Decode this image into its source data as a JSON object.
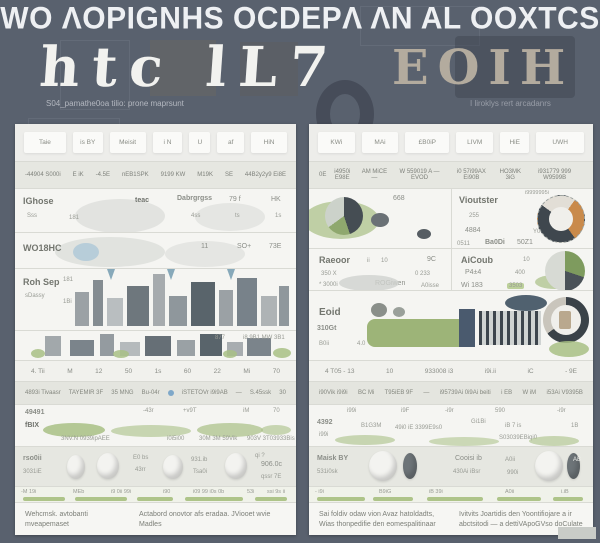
{
  "colors": {
    "background": "#59616e",
    "panel": "#f5f5f2",
    "row_gray": "#e6e7e1",
    "accent_green": "#a8bf85",
    "accent_orange": "#c98a4b",
    "accent_dark": "#3f474e",
    "wordmark_beige": "#b3ab9e",
    "title_white": "#eef0f3"
  },
  "header": {
    "title": "WO ΛOPIGNHS OCDEPΛ ΛN AL OOXTCS",
    "wordmark_left": "htc lL7",
    "wordmark_right": "EOIH",
    "caption_left": "S04_pamathe0oa tilio: prone maprsunt",
    "caption_right": "I liroklys rert arcadanrs"
  },
  "left": {
    "header_cells": [
      "Taie",
      "is  BY",
      "Meisit",
      "i N",
      "U",
      "af",
      "HiN"
    ],
    "subheader_cells": [
      "-44904 S000i",
      "E iK",
      "-4.5E",
      "nEB1SPK",
      "9199 KW",
      "M19K",
      "SE",
      "44B2y2y9 Ei8E"
    ],
    "row_a": {
      "name": "IGhose",
      "sub": "Sss",
      "n1": "181",
      "v1": "teac",
      "v2": "Dabrgrgss",
      "v2s": "4ss",
      "v3": "79 f",
      "v3s": "ts",
      "v4": "HK",
      "v4s": "1s"
    },
    "row_b": {
      "name": "WO18HC",
      "v1": "11",
      "v2": "SO+",
      "v3": "73E"
    },
    "row_c": {
      "name": "Roh Sep",
      "sub": "sDassy",
      "n1": "181",
      "n2": "1Bi"
    },
    "row_d": {
      "v1": "877",
      "v2": "i8 9B1 MW 3B1"
    },
    "numbers_row": [
      "4. Tii",
      "M",
      "12",
      "50",
      "1s",
      "60",
      "22",
      "Mi",
      "70"
    ],
    "gray_row": [
      "4893i Tivaasr",
      "TAYEMIR 3F",
      "35 MNG",
      "Bu-04r",
      "iSTETOVr i9i9AB",
      "—",
      "S.45ssk",
      "30"
    ],
    "hills_row": {
      "name": "49491",
      "sub": "fBIX",
      "v1": "-43r",
      "v2": "+v9T",
      "v3": "iM",
      "v4": "70",
      "cap1": "3NV.N 0939ipAEE",
      "cap2": "i0i5i00",
      "cap3": "30M 3M 59Vik",
      "cap4": "903V 3T03933Bis"
    },
    "stones_row": {
      "name": "rso0ii",
      "sub": "3031iE",
      "v1": "E0 bs",
      "v1s": "43rr",
      "v2": "931.ib",
      "v2s": "Tsa0i",
      "v3": "qi ?",
      "v4": "906.0c",
      "v4s": "qssr 7E"
    },
    "bars_row": {
      "l1": "-M 19i",
      "l2": "MEb",
      "l3": "i9 0ii 99i",
      "l4": "i90",
      "l5": "i09 99 i0s 0b",
      "l6": "53i",
      "l7": "ssi 9s ii"
    },
    "footnote_a": "Wehcmsk. avtobanti mveapemaset",
    "footnote_b": "Actabord onovtor afs eradaa. JViooet wvie Madles"
  },
  "right": {
    "header_cells": [
      "KWi",
      "MAi",
      "£B0iP",
      "LIVM",
      "HiE",
      "UWH"
    ],
    "subheader_cells": [
      "0E",
      "i4950i E98E",
      "AM  MiCE —",
      "W 559019 A — EVOD",
      "i0 57i99AX Ei90B",
      "HO3MK 3iG",
      "i931779 999 W9599B"
    ],
    "note": "i9999995i",
    "row_a": {
      "n0": "668",
      "name": "Vioutster",
      "sub1": "255",
      "sub2": "4884",
      "r1": "0511",
      "r2": "Ba0Di",
      "r3": "50Z1",
      "r4": "Y0"
    },
    "row_b": {
      "name": "Raeoor",
      "n1": "ii",
      "n2": "10",
      "v1": "9C",
      "sub1": "350 X",
      "sub2": "0 233",
      "l2": "* 3000i",
      "l3": "ROGiwen",
      "l4": "A0isse",
      "rname": "AiCoub",
      "rn": "10",
      "rsub": "P4±4",
      "rv": "400",
      "r2a": "Wi 183",
      "r2b": "3503"
    },
    "row_c": {
      "name": "Eoid",
      "sub": "Ai",
      "v1": "310Gt",
      "v2": "B0ii",
      "v3": "4.0"
    },
    "numbers_row": [
      "4 T05 - 13",
      "10",
      "933008 i3",
      "i9i.ii",
      "iC",
      "- 9E"
    ],
    "gray_row": [
      "i90Vik i9i9i",
      "BC Mi",
      "T95iEB 9F",
      "—",
      "i95739Ai 0i9Ai beiti",
      "i EB",
      "W iM",
      "i53Ai V9395B"
    ],
    "hills_row": {
      "t1": "i99i",
      "t2": "i9F",
      "t3": "-i9r",
      "t4": "590",
      "t5": "-i9r",
      "name": "4392",
      "sub": "i99i",
      "v1": "B1G3M",
      "v2": "49i0 iE 3399E9s0",
      "v3": "Gi1Bi",
      "v4": "iB 7 is",
      "v4s": "S03039EBiqi0",
      "v5": "1B"
    },
    "stones_row": {
      "name": "Maisk BY",
      "sub": "531i0sk",
      "mid": "Cooisi ib",
      "mids": "430Ai iBsr",
      "v1": "A0ii",
      "v1s": "990i",
      "v2": "AB"
    },
    "bars_row": {
      "l1": "- i9i",
      "l2": "B9iG",
      "l3": "iB 39i",
      "l4": "A0ii",
      "l5": "i.iB"
    },
    "footnote_a": "Sai foldiv odaw vion Avaz hatoldadts, Wias thonpedifie den eomespalitinaar",
    "footnote_b": "Ivitvits Joartidis den Yoontifiojare a ir abctsitodi — a dettiVApoGVso doCulate"
  },
  "charts": {
    "left_pie": {
      "type": "pie",
      "segments": [
        0.45,
        0.2,
        0.35
      ],
      "palette": [
        "#454d53",
        "#8fa86e",
        "#ccd2ca"
      ]
    },
    "orange_donut": {
      "type": "pie",
      "segments": [
        0.3,
        0.45,
        0.25
      ],
      "palette": [
        "#c98a4b",
        "#3f474e",
        "#e2ded6"
      ]
    },
    "green_pie": {
      "type": "pie",
      "segments": [
        0.3,
        0.2,
        0.5
      ],
      "palette": [
        "#7e9b5e",
        "#4a5258",
        "#d7dad4"
      ]
    },
    "ring_gauge": {
      "type": "pie",
      "segments": [
        0.65,
        0.35
      ],
      "palette": [
        "#3a4248",
        "#c9c5bc"
      ]
    }
  }
}
